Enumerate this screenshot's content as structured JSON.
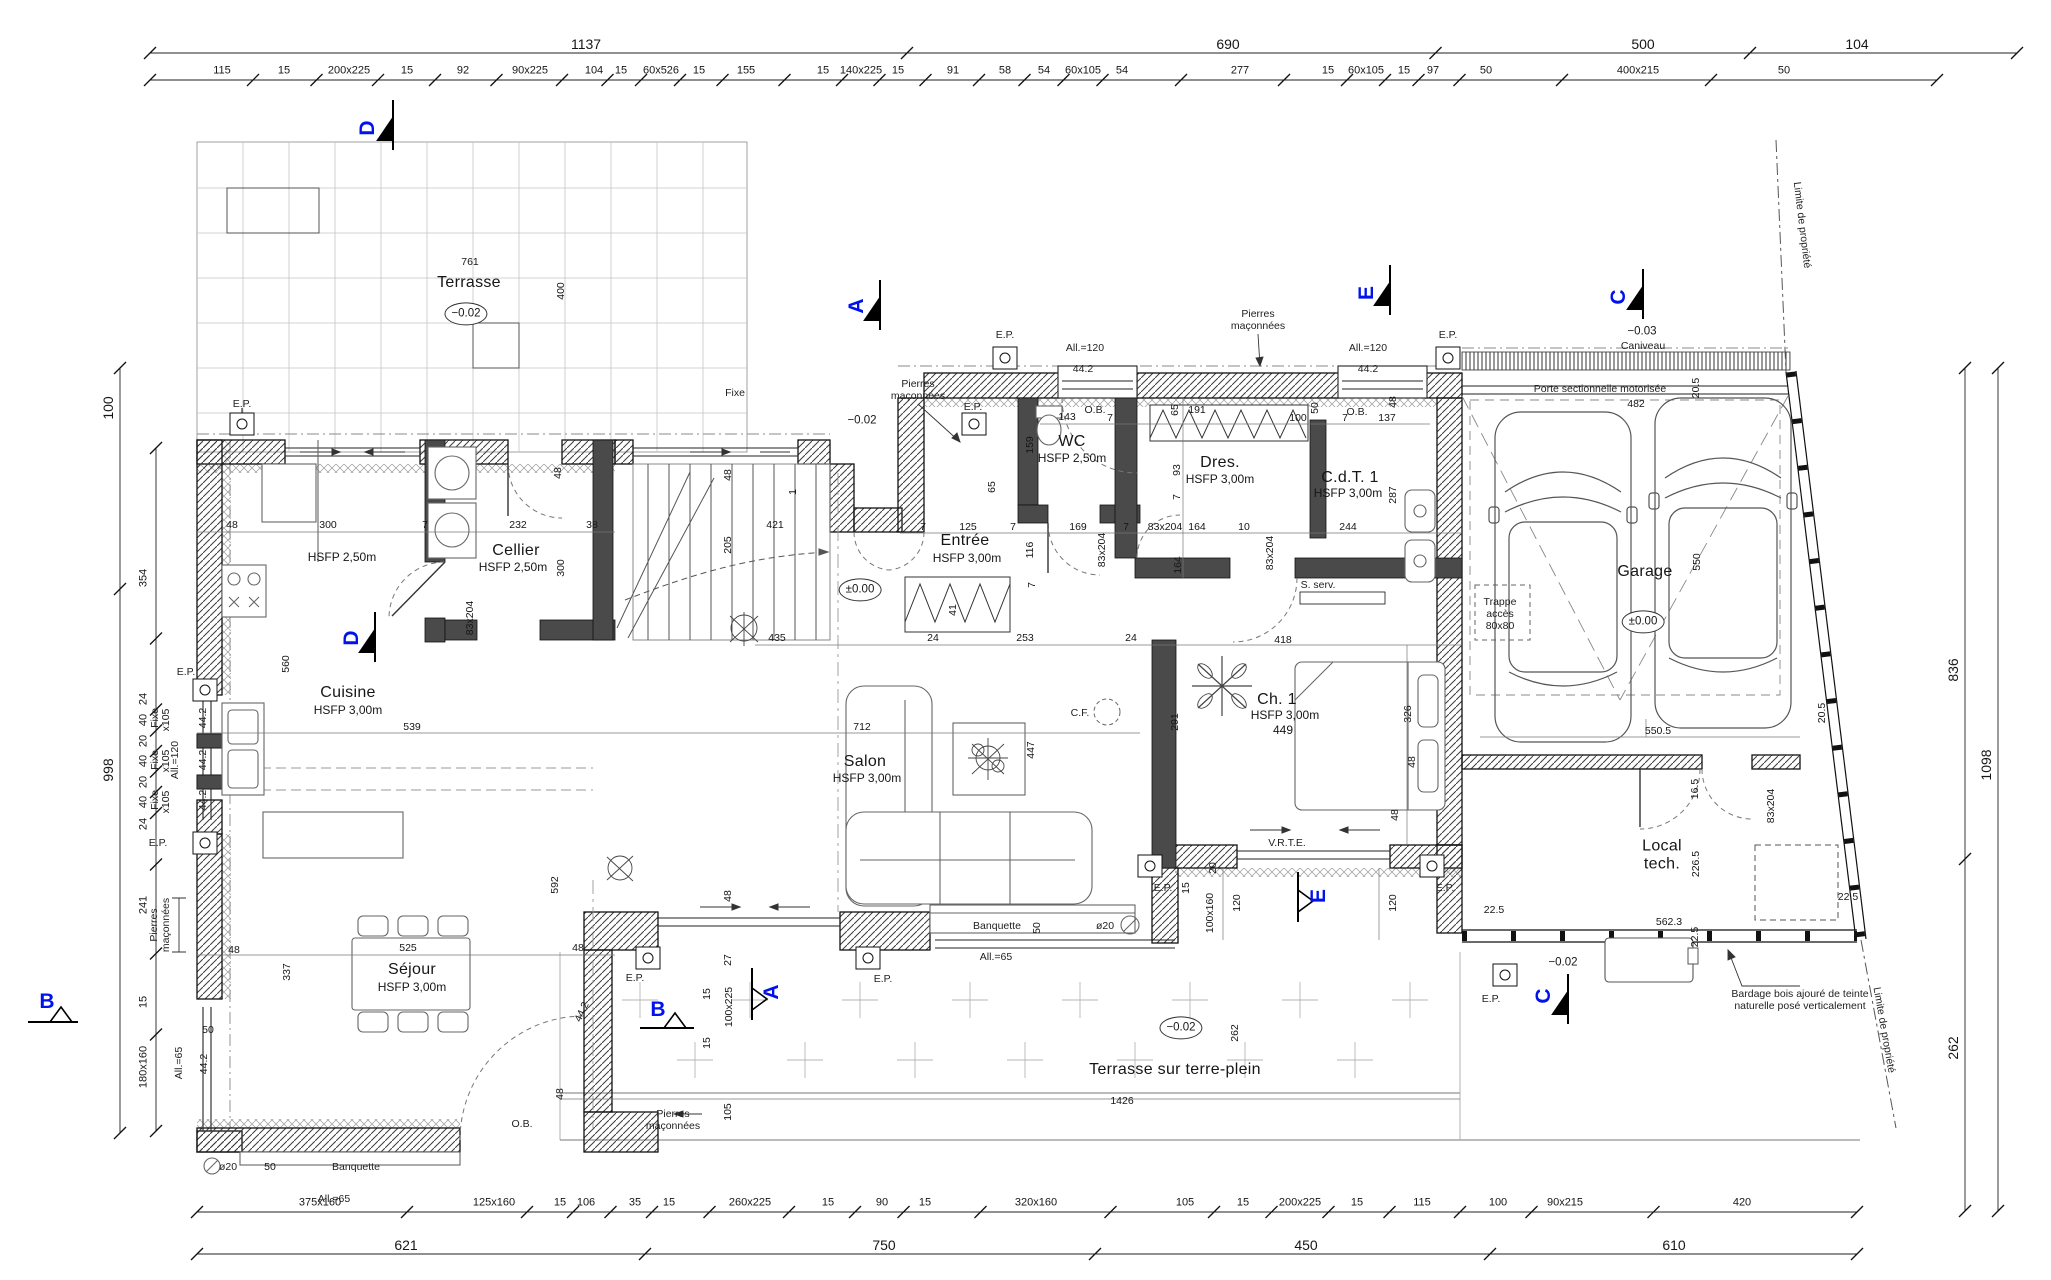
{
  "document": {
    "type": "architectural floor plan",
    "language": "fr"
  },
  "colors": {
    "marker_blue": "#0013ee",
    "line": "#1a1a1a",
    "dim_text": "#222222"
  },
  "plan": {
    "rooms": [
      [
        "Terrasse",
        469,
        283
      ],
      [
        "Cuisine",
        348,
        693
      ],
      [
        "Cellier",
        516,
        551
      ],
      [
        "Entrée",
        965,
        541
      ],
      [
        "WC",
        1072,
        442
      ],
      [
        "Dres.",
        1220,
        463
      ],
      [
        "C.d.T. 1",
        1350,
        478
      ],
      [
        "Ch. 1",
        1277,
        700
      ],
      [
        "Salon",
        865,
        762
      ],
      [
        "Séjour",
        412,
        970
      ],
      [
        "Garage",
        1645,
        572
      ],
      [
        "Local\ntech.",
        1662,
        856
      ],
      [
        "Terrasse sur terre-plein",
        1175,
        1070
      ]
    ],
    "ceiling_heights": [
      [
        "HSFP 3,00m",
        348,
        711
      ],
      [
        "HSFP 2,50m",
        342,
        558
      ],
      [
        "HSFP 2,50m",
        513,
        568
      ],
      [
        "HSFP 3,00m",
        967,
        559
      ],
      [
        "HSFP 2,50m",
        1072,
        459
      ],
      [
        "HSFP 3,00m",
        1220,
        480
      ],
      [
        "HSFP 3,00m",
        1348,
        494
      ],
      [
        "HSFP 3,00m",
        1285,
        716
      ],
      [
        "449",
        1283,
        731
      ],
      [
        "HSFP 3,00m",
        867,
        779
      ],
      [
        "HSFP 3,00m",
        412,
        988
      ]
    ],
    "levels_circled": [
      [
        "−0.02",
        466,
        314
      ],
      [
        "±0.00",
        860,
        590
      ],
      [
        "±0.00",
        1643,
        622
      ],
      [
        "−0.02",
        1181,
        1028
      ]
    ],
    "levels_plain": [
      [
        "−0.02",
        862,
        421
      ],
      [
        "−0.02",
        1563,
        963
      ],
      [
        "−0.03",
        1642,
        332
      ]
    ],
    "dim_chains": {
      "top_overall": {
        "y": 53,
        "x1": 150,
        "x2": 2017,
        "cls": "chaintot",
        "labels": [
          [
            "1137",
            586
          ],
          [
            "690",
            1228
          ],
          [
            "500",
            1643
          ],
          [
            "104",
            1857
          ]
        ]
      },
      "top_detail": {
        "y": 80,
        "x1": 150,
        "x2": 1937,
        "cls": "chain",
        "labels": [
          [
            "115",
            222
          ],
          [
            "15",
            284
          ],
          [
            "200x225",
            349
          ],
          [
            "15",
            407
          ],
          [
            "92",
            463
          ],
          [
            "90x225",
            530
          ],
          [
            "104",
            594
          ],
          [
            "15",
            621
          ],
          [
            "60x526",
            661
          ],
          [
            "15",
            699
          ],
          [
            "155",
            746
          ],
          [
            "15",
            823
          ],
          [
            "140x225",
            861
          ],
          [
            "15",
            898
          ],
          [
            "91",
            953
          ],
          [
            "58",
            1005
          ],
          [
            "54",
            1044
          ],
          [
            "60x105",
            1083
          ],
          [
            "54",
            1122
          ],
          [
            "277",
            1240
          ],
          [
            "15",
            1328
          ],
          [
            "60x105",
            1366
          ],
          [
            "15",
            1404
          ],
          [
            "97",
            1433
          ],
          [
            "50",
            1486
          ],
          [
            "400x215",
            1638
          ],
          [
            "50",
            1784
          ]
        ]
      },
      "bottom_detail": {
        "y": 1212,
        "x1": 197,
        "x2": 1857,
        "cls": "chain",
        "labels": [
          [
            "375x160",
            320
          ],
          [
            "125x160",
            494
          ],
          [
            "15",
            560
          ],
          [
            "106",
            586
          ],
          [
            "35",
            635
          ],
          [
            "15",
            669
          ],
          [
            "260x225",
            750
          ],
          [
            "15",
            828
          ],
          [
            "90",
            882
          ],
          [
            "15",
            925
          ],
          [
            "320x160",
            1036
          ],
          [
            "105",
            1185
          ],
          [
            "15",
            1243
          ],
          [
            "200x225",
            1300
          ],
          [
            "15",
            1357
          ],
          [
            "115",
            1422
          ],
          [
            "100",
            1498
          ],
          [
            "90x215",
            1565
          ],
          [
            "420",
            1742
          ]
        ]
      },
      "bottom_overall": {
        "y": 1254,
        "x1": 197,
        "x2": 1857,
        "cls": "chaintot",
        "labels": [
          [
            "621",
            406
          ],
          [
            "750",
            884
          ],
          [
            "450",
            1306
          ],
          [
            "610",
            1674
          ]
        ]
      },
      "left_overall": {
        "x": 120,
        "y1": 368,
        "y2": 1133,
        "cls": "chaintot",
        "vertical": true,
        "labels": [
          [
            "100",
            408
          ],
          [
            "998",
            770
          ]
        ]
      },
      "left_detail": {
        "x": 156,
        "y1": 448,
        "y2": 1131,
        "cls": "chain",
        "vertical": true,
        "labels": [
          [
            "354",
            578
          ],
          [
            "24",
            699
          ],
          [
            "40",
            720
          ],
          [
            "20",
            741
          ],
          [
            "40",
            761
          ],
          [
            "20",
            782
          ],
          [
            "40",
            802
          ],
          [
            "24",
            824
          ],
          [
            "241",
            905
          ],
          [
            "15",
            1002
          ],
          [
            "180x160",
            1067
          ]
        ]
      },
      "right_inner": {
        "x": 1965,
        "y1": 368,
        "y2": 1211,
        "cls": "chaintot",
        "vertical": true,
        "labels": [
          [
            "836",
            670
          ],
          [
            "262",
            1048
          ]
        ]
      },
      "right_outer": {
        "x": 1998,
        "y1": 368,
        "y2": 1211,
        "cls": "chaintot",
        "vertical": true,
        "labels": [
          [
            "1098",
            765
          ]
        ]
      }
    },
    "dim_labels": [
      [
        "48",
        232,
        525
      ],
      [
        "300",
        328,
        525
      ],
      [
        "7",
        425,
        525
      ],
      [
        "232",
        518,
        525
      ],
      [
        "38",
        592,
        525
      ],
      [
        "48",
        558,
        473,
        -90
      ],
      [
        "300",
        561,
        568,
        -90
      ],
      [
        "560",
        286,
        664,
        -90
      ],
      [
        "83x204",
        470,
        618,
        -90
      ],
      [
        "7",
        923,
        527
      ],
      [
        "125",
        968,
        527
      ],
      [
        "7",
        1013,
        527
      ],
      [
        "169",
        1078,
        527
      ],
      [
        "7",
        1126,
        527
      ],
      [
        "83x204",
        1165,
        527
      ],
      [
        "164",
        1197,
        527
      ],
      [
        "10",
        1244,
        527
      ],
      [
        "244",
        1348,
        527
      ],
      [
        "421",
        775,
        525
      ],
      [
        "83x204",
        1102,
        550,
        -90
      ],
      [
        "116",
        1030,
        550,
        -90
      ],
      [
        "205",
        728,
        545,
        -90
      ],
      [
        "48",
        728,
        475,
        -90
      ],
      [
        "1",
        793,
        492,
        -90
      ],
      [
        "65",
        992,
        487,
        -90
      ],
      [
        "41",
        953,
        610,
        -90
      ],
      [
        "7",
        1032,
        585,
        -90
      ],
      [
        "93",
        1177,
        470,
        -90
      ],
      [
        "7",
        1177,
        497,
        -90
      ],
      [
        "164",
        1178,
        565,
        -90
      ],
      [
        "287",
        1393,
        495,
        -90
      ],
      [
        "83x204",
        1270,
        553,
        -90
      ],
      [
        "159",
        1030,
        445,
        -90
      ],
      [
        "143",
        1067,
        417
      ],
      [
        "7",
        1110,
        418
      ],
      [
        "100",
        1298,
        418
      ],
      [
        "7",
        1345,
        418
      ],
      [
        "137",
        1387,
        418
      ],
      [
        "50",
        1315,
        408,
        -90
      ],
      [
        "48",
        1393,
        402,
        -90
      ],
      [
        "65",
        1175,
        410,
        -90
      ],
      [
        "191",
        1197,
        410
      ],
      [
        "435",
        777,
        638
      ],
      [
        "24",
        933,
        638
      ],
      [
        "253",
        1025,
        638
      ],
      [
        "24",
        1131,
        638
      ],
      [
        "418",
        1283,
        640
      ],
      [
        "291",
        1175,
        722,
        -90
      ],
      [
        "447",
        1031,
        750,
        -90
      ],
      [
        "326",
        1408,
        714,
        -90
      ],
      [
        "48",
        1412,
        762,
        -90
      ],
      [
        "48",
        1395,
        815,
        -90
      ],
      [
        "539",
        412,
        727
      ],
      [
        "712",
        862,
        727
      ],
      [
        "48",
        234,
        950
      ],
      [
        "525",
        408,
        948
      ],
      [
        "48",
        578,
        948
      ],
      [
        "48",
        728,
        896,
        -90
      ],
      [
        "27",
        728,
        960,
        -90
      ],
      [
        "15",
        707,
        994,
        -90
      ],
      [
        "100x225",
        729,
        1007,
        -90
      ],
      [
        "15",
        707,
        1043,
        -90
      ],
      [
        "105",
        728,
        1112,
        -90
      ],
      [
        "48",
        560,
        1094,
        -90
      ],
      [
        "592",
        555,
        885,
        -90
      ],
      [
        "337",
        287,
        972,
        -90
      ],
      [
        "120",
        1237,
        903,
        -90
      ],
      [
        "120",
        1393,
        903,
        -90
      ],
      [
        "100x160",
        1210,
        913,
        -90
      ],
      [
        "20",
        1213,
        868,
        -90
      ],
      [
        "15",
        1186,
        888,
        -90
      ],
      [
        "262",
        1235,
        1033,
        -90
      ],
      [
        "1426",
        1122,
        1101
      ],
      [
        "550",
        1697,
        562,
        -90
      ],
      [
        "550.5",
        1658,
        731
      ],
      [
        "20.5",
        1822,
        713,
        -90
      ],
      [
        "20.5",
        1696,
        388,
        -90
      ],
      [
        "16.5",
        1695,
        789,
        -90
      ],
      [
        "226.5",
        1696,
        864,
        -90
      ],
      [
        "562.3",
        1669,
        922
      ],
      [
        "22.5",
        1494,
        910
      ],
      [
        "22.5",
        1848,
        897
      ],
      [
        "22.5",
        1695,
        937,
        -90
      ],
      [
        "83x204",
        1771,
        806,
        -90
      ],
      [
        "761",
        470,
        262
      ],
      [
        "400",
        561,
        291,
        -90
      ],
      [
        "x105",
        166,
        720,
        -90
      ],
      [
        "x105",
        166,
        761,
        -90
      ],
      [
        "x105",
        166,
        802,
        -90
      ],
      [
        "50",
        208,
        1030
      ],
      [
        "50",
        270,
        1167
      ],
      [
        "50",
        1037,
        928,
        -90
      ],
      [
        "482",
        1636,
        404
      ]
    ],
    "annotations": [
      [
        "E.P.",
        242,
        404
      ],
      [
        "E.P.",
        186,
        672
      ],
      [
        "E.P.",
        158,
        843
      ],
      [
        "E.P.",
        635,
        978
      ],
      [
        "E.P.",
        883,
        979
      ],
      [
        "E.P.",
        973,
        407
      ],
      [
        "E.P.",
        1005,
        335
      ],
      [
        "E.P.",
        1448,
        335
      ],
      [
        "E.P.",
        1163,
        888
      ],
      [
        "E.P.",
        1445,
        888
      ],
      [
        "E.P.",
        1491,
        999
      ],
      [
        "O.B.",
        1095,
        410
      ],
      [
        "O.B.",
        1357,
        412
      ],
      [
        "O.B.",
        522,
        1124
      ],
      [
        "Fixe",
        735,
        393
      ],
      [
        "Fixe",
        155,
        718,
        -90
      ],
      [
        "Fixe",
        155,
        760,
        -90
      ],
      [
        "Fixe",
        155,
        800,
        -90
      ],
      [
        "All.=120",
        1085,
        348
      ],
      [
        "All.=120",
        1368,
        348
      ],
      [
        "All.=120",
        175,
        760,
        -90
      ],
      [
        "All.=65",
        996,
        957
      ],
      [
        "All.=65",
        334,
        1199
      ],
      [
        "All.=65",
        179,
        1063,
        -90
      ],
      [
        "44.2",
        1083,
        369
      ],
      [
        "44.2",
        1368,
        369
      ],
      [
        "44.2",
        203,
        718,
        -90
      ],
      [
        "44.2",
        203,
        760,
        -90
      ],
      [
        "44.2",
        203,
        800,
        -90
      ],
      [
        "44.2",
        204,
        1064,
        -90
      ],
      [
        "44.2",
        582,
        1012,
        -65
      ],
      [
        "Banquette",
        997,
        926
      ],
      [
        "Banquette",
        356,
        1167
      ],
      [
        "ø20",
        1105,
        926
      ],
      [
        "ø20",
        228,
        1167
      ],
      [
        "V.R.T.E.",
        1287,
        843
      ],
      [
        "C.F.",
        1080,
        713
      ],
      [
        "S. serv.",
        1318,
        585
      ],
      [
        "Caniveau",
        1643,
        346
      ]
    ],
    "notes": [
      [
        "Pierres\nmaçonnées",
        918,
        390,
        0
      ],
      [
        "Pierres\nmaçonnées",
        1258,
        320,
        0
      ],
      [
        "Pierres\nmaçonnées",
        160,
        925,
        -90
      ],
      [
        "Pierres\nmaçonnées",
        673,
        1120,
        0
      ],
      [
        "Porte  sectionnelle  motorisée",
        1600,
        389,
        0
      ],
      [
        "Trappe\naccès\n80x80",
        1500,
        614,
        0
      ],
      [
        "Bardage bois ajouré de teinte\nnaturelle posé verticalement",
        1800,
        1000,
        0
      ],
      [
        "Limite de propriété",
        1802,
        225,
        83
      ],
      [
        "Limite de propriété",
        1884,
        1030,
        80
      ]
    ],
    "section_markers": [
      [
        "D",
        368,
        128,
        -90
      ],
      [
        "A",
        857,
        306,
        -90
      ],
      [
        "E",
        1367,
        293,
        -90
      ],
      [
        "C",
        1619,
        297,
        -90
      ],
      [
        "D",
        352,
        638,
        -90
      ],
      [
        "B",
        47,
        1002,
        0
      ],
      [
        "B",
        658,
        1010,
        0
      ],
      [
        "A",
        772,
        992,
        -90
      ],
      [
        "E",
        1319,
        896,
        -90
      ],
      [
        "C",
        1544,
        996,
        -90
      ]
    ]
  }
}
